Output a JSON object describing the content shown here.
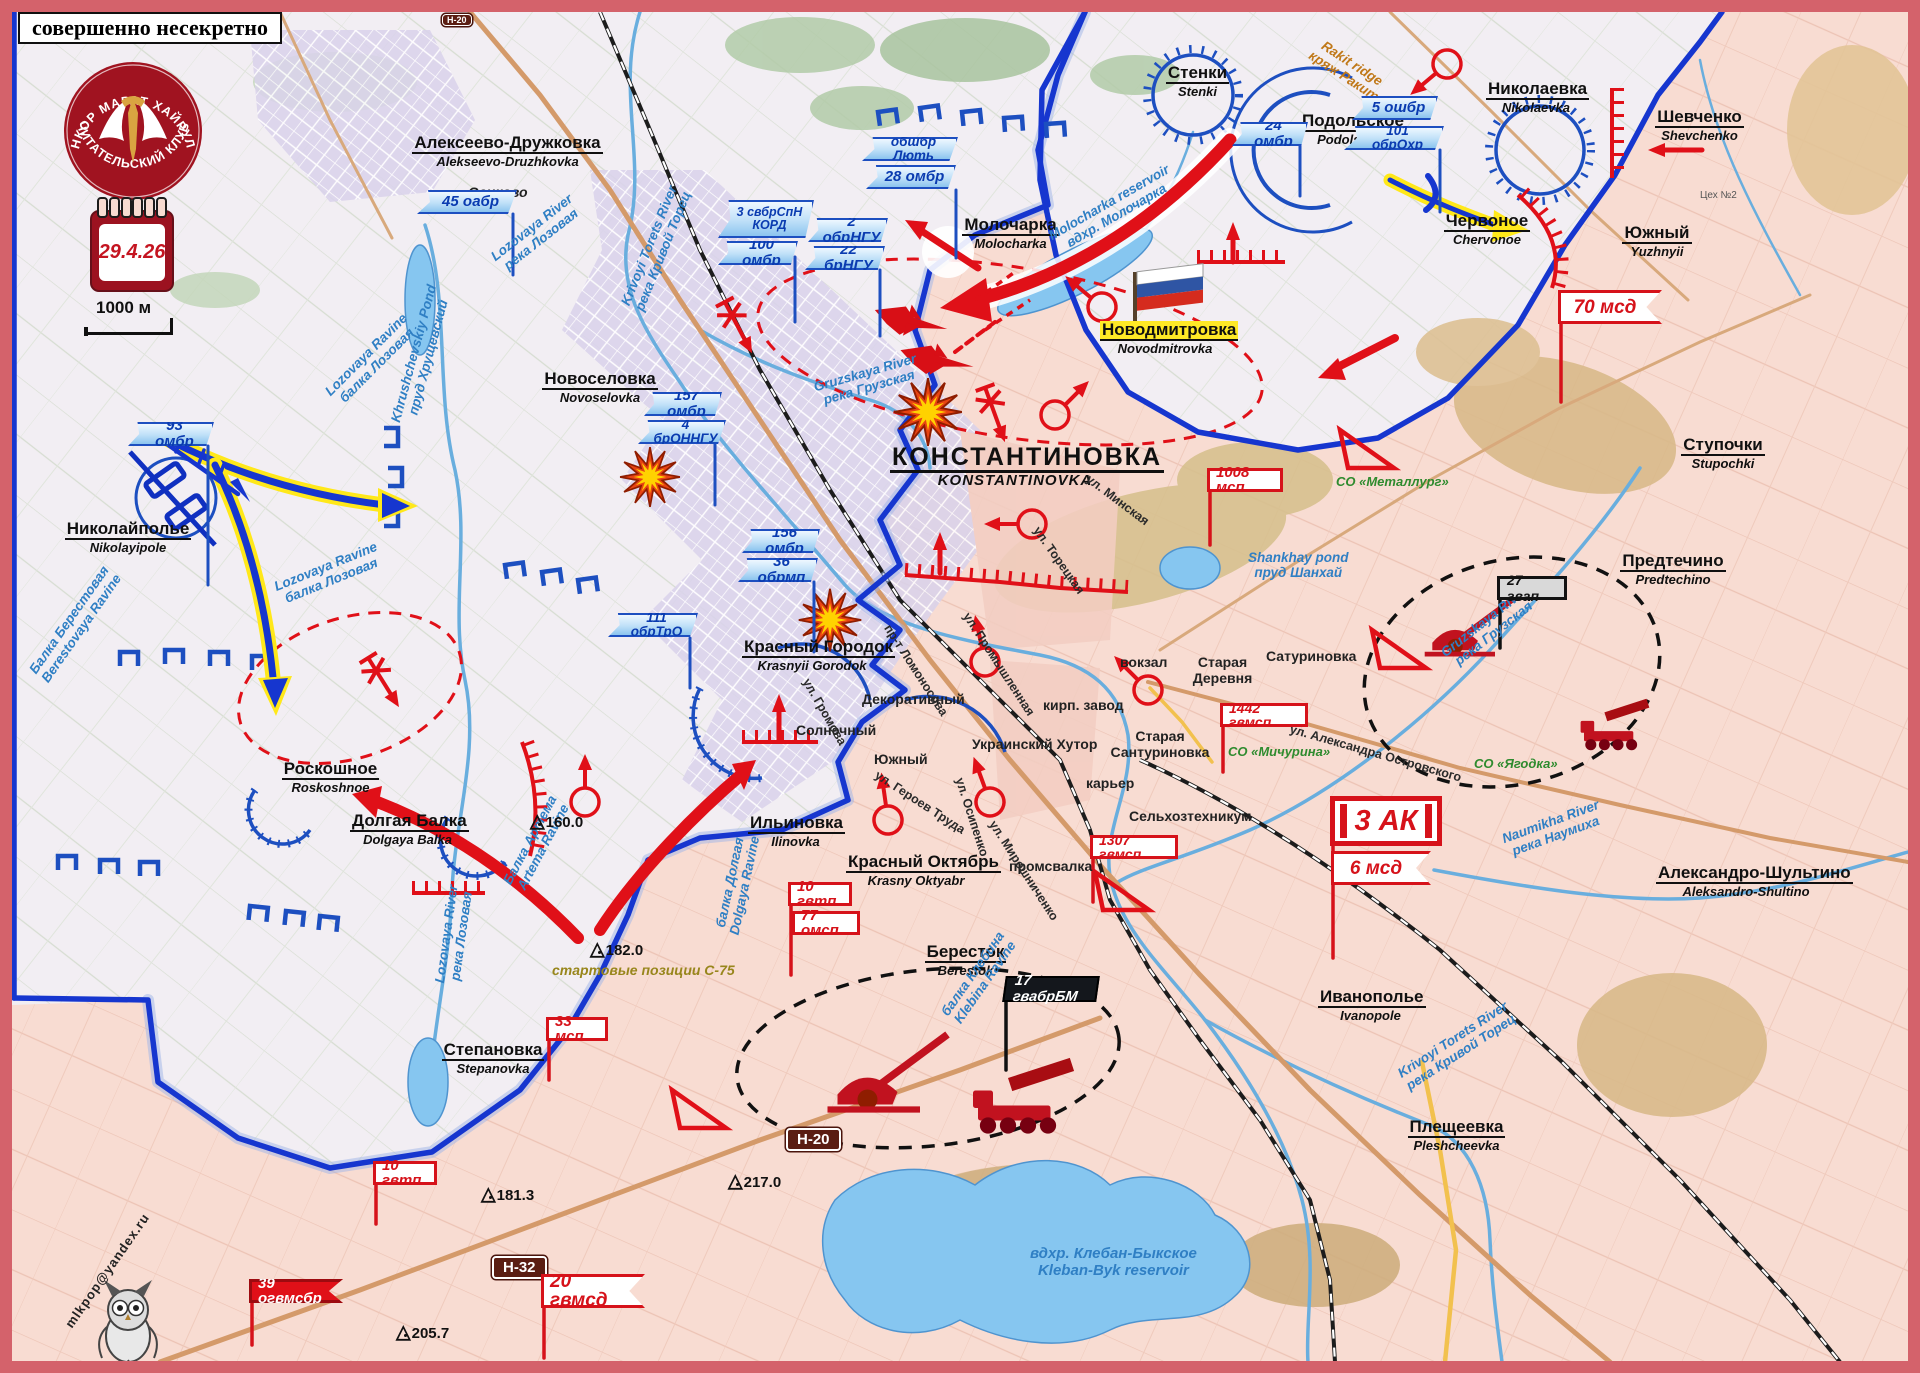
{
  "frame": {
    "classification": "совершенно несекретно"
  },
  "logo": {
    "arc_top": "ВОЕНКОР МАРАТ ХАЙРУЛЛИН",
    "arc_bottom": "ЧИТАТЕЛЬСКИЙ КЛУБ",
    "date": "29.4.26",
    "scale": "1000 м",
    "email": "mlkpop@yandex.ru"
  },
  "ua_units": [
    {
      "label": "45 оабр"
    },
    {
      "label": "93 омбр"
    },
    {
      "label": "157 омбр"
    },
    {
      "label": "4 брОННГУ"
    },
    {
      "label": "156 омбр"
    },
    {
      "label": "36 обрмп"
    },
    {
      "label": "111 обрТрО"
    },
    {
      "label": "3 свбрСпН КОРД"
    },
    {
      "label": "100 омбр"
    },
    {
      "label": "2 обрНГУ"
    },
    {
      "label": "22 брНГУ"
    },
    {
      "label": "обшбр Лють"
    },
    {
      "label": "28 омбр"
    },
    {
      "label": "24 омбр"
    },
    {
      "label": "5 ошбр"
    },
    {
      "label": "101 обрОхр"
    }
  ],
  "ru_units": [
    {
      "label": "1008 мсп"
    },
    {
      "label": "1442 гвмсп"
    },
    {
      "label": "1307 гвмсп"
    },
    {
      "label": "10 гвтп"
    },
    {
      "label": "77 омсп"
    },
    {
      "label": "33 мсп"
    },
    {
      "label": "10 гвтп"
    },
    {
      "label": "39 огвмсбр"
    },
    {
      "label": "20 гвмсд"
    },
    {
      "label": "70 мсд"
    },
    {
      "label": "3 АК"
    },
    {
      "label": "6 мсд"
    },
    {
      "label": "27 гвап"
    },
    {
      "label": "17 гвабрБМ"
    }
  ],
  "places": [
    {
      "name": "Алексеево-Дружковка",
      "translit": "Alekseevo-Druzhkovka"
    },
    {
      "name": "Осиково",
      "translit": ""
    },
    {
      "name": "Новоселовка",
      "translit": "Novoselovka"
    },
    {
      "name": "Николайполье",
      "translit": "Nikolayipole"
    },
    {
      "name": "Роскошное",
      "translit": "Roskoshnoe"
    },
    {
      "name": "Долгая Балка",
      "translit": "Dolgaya Balka"
    },
    {
      "name": "Степановка",
      "translit": "Stepanovka"
    },
    {
      "name": "Ильиновка",
      "translit": "Ilinovka"
    },
    {
      "name": "Красный Городок",
      "translit": "Krasnyii Gorodok"
    },
    {
      "name": "Красный Октябрь",
      "translit": "Krasny Oktyabr"
    },
    {
      "name": "Бересток",
      "translit": "Berestok"
    },
    {
      "name": "Молочарка",
      "translit": "Molocharka"
    },
    {
      "name": "Стенки",
      "translit": "Stenki"
    },
    {
      "name": "Подольское",
      "translit": "Podolskoe"
    },
    {
      "name": "Николаевка",
      "translit": "Nikolaevka"
    },
    {
      "name": "Шевченко",
      "translit": "Shevchenko"
    },
    {
      "name": "Червоное",
      "translit": "Chervonoe"
    },
    {
      "name": "Южный",
      "translit": "Yuzhnyii"
    },
    {
      "name": "Новодмитровка",
      "translit": "Novodmitrovka"
    },
    {
      "name": "КОНСТАНТИНОВКА",
      "translit": "KONSTANTINOVKA"
    },
    {
      "name": "Ступочки",
      "translit": "Stupochki"
    },
    {
      "name": "Предтечино",
      "translit": "Predtechino"
    },
    {
      "name": "Иванополье",
      "translit": "Ivanopole"
    },
    {
      "name": "Плещеевка",
      "translit": "Pleshcheevka"
    },
    {
      "name": "Александро-Шультино",
      "translit": "Aleksandro-Shultino"
    },
    {
      "name": "Сатуриновка"
    },
    {
      "name": "Старая Деревня"
    },
    {
      "name": "Старая Сантуриновка"
    },
    {
      "name": "Украинский Хутор"
    },
    {
      "name": "Декоративный"
    },
    {
      "name": "Солнечный"
    },
    {
      "name": "Южный"
    },
    {
      "name": "вокзал"
    },
    {
      "name": "кирп. завод"
    },
    {
      "name": "карьер"
    },
    {
      "name": "Сельхозтехникум"
    },
    {
      "name": "промсвалка"
    },
    {
      "name": "Цех №2"
    }
  ],
  "waters": [
    {
      "l1": "Lozovaya River",
      "l2": "река Лозовая"
    },
    {
      "l1": "Krivoyi Torets River",
      "l2": "река Кривой Торец"
    },
    {
      "l1": "Gruzskaya River",
      "l2": "река Грузская"
    },
    {
      "l1": "Gruzskaya River",
      "l2": "река Грузская"
    },
    {
      "l1": "Molocharka reservoir",
      "l2": "вдхр. Молочарка"
    },
    {
      "l1": "Shankhay pond",
      "l2": "пруд Шанхай"
    },
    {
      "l1": "вдхр. Клебан-Быкское",
      "l2": "Kleban-Byk reservoir"
    },
    {
      "l1": "Naumikha River",
      "l2": "река Наумиха"
    },
    {
      "l1": "Krivoyi Torets River",
      "l2": "река Кривой Торец"
    },
    {
      "l1": "Lozovaya Ravine",
      "l2": "балка Лозовая"
    },
    {
      "l1": "Lozovaya Ravine",
      "l2": "балка Лозовая"
    },
    {
      "l1": "Балка Берестовая",
      "l2": "Berestovaya Ravine"
    },
    {
      "l1": "Балка Артема",
      "l2": "Artema Ravine"
    },
    {
      "l1": "балка Долгая",
      "l2": "Dolgaya Ravine"
    },
    {
      "l1": "балка Клебина",
      "l2": "Klebina Ravine"
    },
    {
      "l1": "Lozovaya River",
      "l2": "река Лозовая"
    },
    {
      "l1": "Khrushchevskiy Pond",
      "l2": "пруд Хрущевский"
    }
  ],
  "streets": [
    {
      "name": "ул. Минская"
    },
    {
      "name": "ул. Торецкая"
    },
    {
      "name": "пр-т Ломоносова"
    },
    {
      "name": "ул. Промышленная"
    },
    {
      "name": "ул. Громова"
    },
    {
      "name": "ул. Героев Труда"
    },
    {
      "name": "ул. Осипенко"
    },
    {
      "name": "ул. Мирошниченко"
    },
    {
      "name": "ул. Александра Островского"
    }
  ],
  "gardens": [
    {
      "name": "СО «Металлург»"
    },
    {
      "name": "СО «Мичурина»"
    },
    {
      "name": "СО «Ягодка»"
    }
  ],
  "ridge": {
    "l1": "Rakit ridge",
    "l2": "кряж Ракит"
  },
  "signs": [
    {
      "label": "Н-20"
    },
    {
      "label": "Н-20"
    },
    {
      "label": "Н-32"
    }
  ],
  "elevations": [
    {
      "value": "160.0"
    },
    {
      "value": "182.0"
    },
    {
      "value": "181.3"
    },
    {
      "value": "217.0"
    },
    {
      "value": "205.7"
    }
  ],
  "notes": [
    {
      "text": "стартовые позиции С-75"
    }
  ]
}
